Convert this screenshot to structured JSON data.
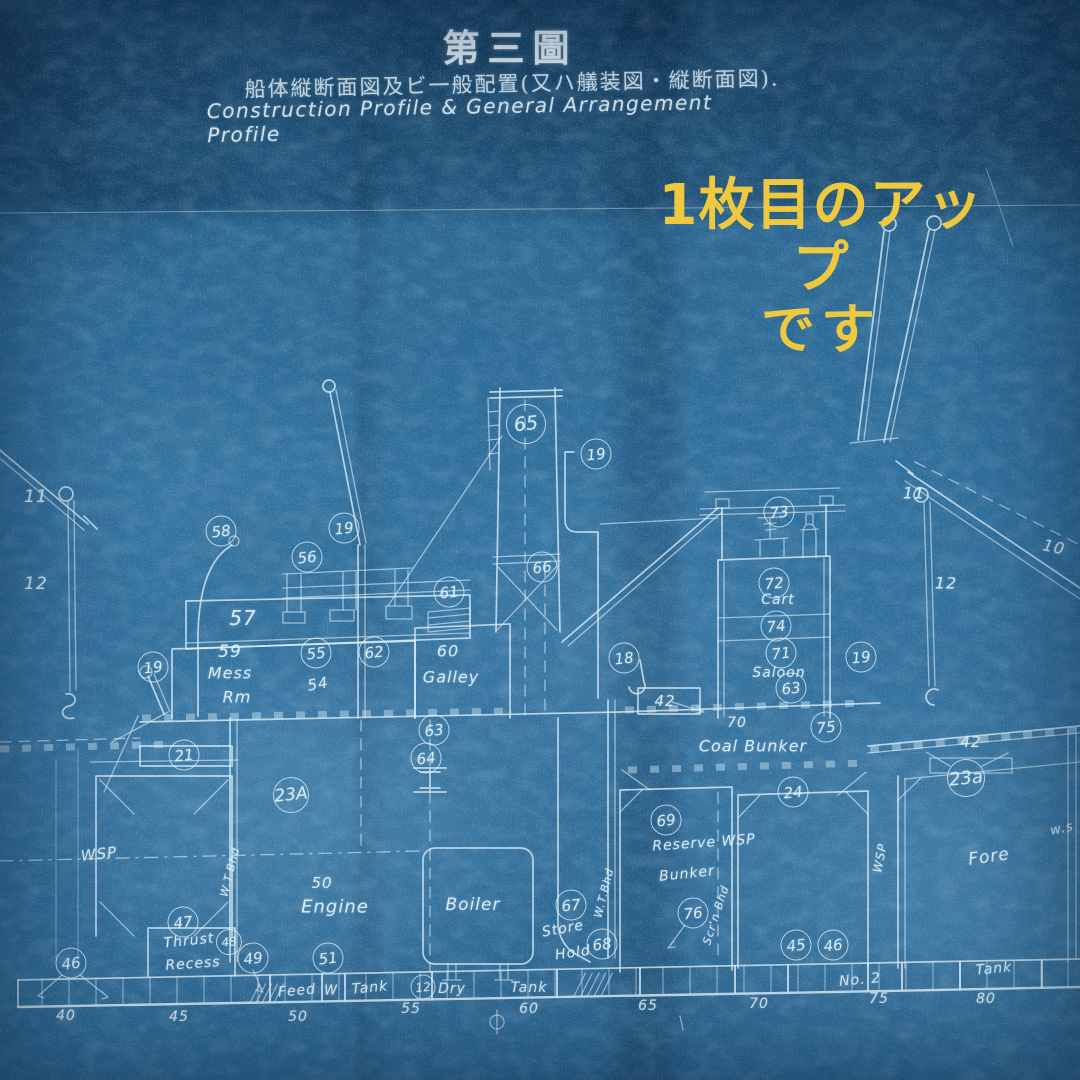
{
  "header": {
    "title_jp": "第三圖",
    "subtitle_jp": "船体縦断面図及ビ一般配置(又ハ艤装図・縦断面図).",
    "subtitle_en": "Construction Profile & General Arrangement Profile"
  },
  "overlay_note": {
    "line1": "1枚目のアップ",
    "line2": "です",
    "color": "#efc93d"
  },
  "colors": {
    "paper": "#2e6f9d",
    "line": "#dceef9",
    "lettering": "#e4f3fc"
  },
  "labels": [
    {
      "t": "11",
      "x": 36,
      "y": 497,
      "s": 17
    },
    {
      "t": "12",
      "x": 36,
      "y": 584,
      "s": 17
    },
    {
      "t": "11",
      "x": 914,
      "y": 493,
      "s": 16
    },
    {
      "t": "12",
      "x": 946,
      "y": 583,
      "s": 16
    },
    {
      "t": "10",
      "x": 1054,
      "y": 547,
      "s": 16,
      "r": 12
    },
    {
      "t": "57",
      "x": 243,
      "y": 618,
      "s": 20
    },
    {
      "t": "59",
      "x": 230,
      "y": 652,
      "s": 17
    },
    {
      "t": "Mess",
      "x": 230,
      "y": 673,
      "s": 16
    },
    {
      "t": "Rm",
      "x": 237,
      "y": 697,
      "s": 16
    },
    {
      "t": "54",
      "x": 318,
      "y": 684,
      "s": 15,
      "r": -10
    },
    {
      "t": "60",
      "x": 448,
      "y": 651,
      "s": 16
    },
    {
      "t": "Galley",
      "x": 451,
      "y": 677,
      "s": 16
    },
    {
      "t": "42",
      "x": 665,
      "y": 701,
      "s": 15
    },
    {
      "t": "Cart",
      "x": 778,
      "y": 600,
      "s": 14
    },
    {
      "t": "Saloon",
      "x": 779,
      "y": 673,
      "s": 14
    },
    {
      "t": "70",
      "x": 737,
      "y": 723,
      "s": 14
    },
    {
      "t": "Coal Bunker",
      "x": 753,
      "y": 746,
      "s": 16
    },
    {
      "t": "42",
      "x": 971,
      "y": 742,
      "s": 15
    },
    {
      "t": "WSP",
      "x": 99,
      "y": 854,
      "s": 15,
      "r": -6
    },
    {
      "t": "WSP",
      "x": 880,
      "y": 858,
      "s": 12,
      "r": -78
    },
    {
      "t": "w.s",
      "x": 1062,
      "y": 829,
      "s": 13,
      "r": -12
    },
    {
      "t": "Fore",
      "x": 989,
      "y": 857,
      "s": 17,
      "r": -8
    },
    {
      "t": "50",
      "x": 322,
      "y": 883,
      "s": 15
    },
    {
      "t": "Engine",
      "x": 335,
      "y": 907,
      "s": 18
    },
    {
      "t": "Boiler",
      "x": 473,
      "y": 905,
      "s": 17
    },
    {
      "t": "Store",
      "x": 563,
      "y": 929,
      "s": 14,
      "r": -10
    },
    {
      "t": "Hold",
      "x": 573,
      "y": 953,
      "s": 14,
      "r": -8
    },
    {
      "t": "Reserve WSP",
      "x": 704,
      "y": 843,
      "s": 14,
      "r": -4
    },
    {
      "t": "Bunker",
      "x": 687,
      "y": 874,
      "s": 14,
      "r": -6
    },
    {
      "t": "Thrust",
      "x": 189,
      "y": 941,
      "s": 14,
      "r": -6
    },
    {
      "t": "Recess",
      "x": 193,
      "y": 964,
      "s": 14,
      "r": -4
    },
    {
      "t": "Feed",
      "x": 297,
      "y": 991,
      "s": 14,
      "r": -5
    },
    {
      "t": "W",
      "x": 331,
      "y": 991,
      "s": 13
    },
    {
      "t": "Tank",
      "x": 370,
      "y": 988,
      "s": 14,
      "r": -5
    },
    {
      "t": "Dry",
      "x": 452,
      "y": 989,
      "s": 14
    },
    {
      "t": "Tank",
      "x": 529,
      "y": 988,
      "s": 14
    },
    {
      "t": "No. 2",
      "x": 860,
      "y": 980,
      "s": 14,
      "r": -5
    },
    {
      "t": "Tank",
      "x": 994,
      "y": 969,
      "s": 14,
      "r": -5
    },
    {
      "t": "W.T.Bhd",
      "x": 230,
      "y": 872,
      "s": 11,
      "r": -76
    },
    {
      "t": "W.T.Bhd",
      "x": 604,
      "y": 893,
      "s": 11,
      "r": -76
    },
    {
      "t": "Scr'n Bhd",
      "x": 716,
      "y": 915,
      "s": 11,
      "r": -72
    },
    {
      "t": "40",
      "x": 66,
      "y": 1016,
      "s": 14
    },
    {
      "t": "45",
      "x": 179,
      "y": 1017,
      "s": 14
    },
    {
      "t": "50",
      "x": 298,
      "y": 1017,
      "s": 14
    },
    {
      "t": "55",
      "x": 411,
      "y": 1009,
      "s": 14
    },
    {
      "t": "60",
      "x": 529,
      "y": 1009,
      "s": 14
    },
    {
      "t": "65",
      "x": 648,
      "y": 1006,
      "s": 14
    },
    {
      "t": "70",
      "x": 759,
      "y": 1004,
      "s": 14
    },
    {
      "t": "75",
      "x": 879,
      "y": 999,
      "s": 14
    },
    {
      "t": "80",
      "x": 986,
      "y": 999,
      "s": 14
    }
  ],
  "circles": [
    {
      "t": "58",
      "x": 221,
      "y": 531
    },
    {
      "t": "19",
      "x": 344,
      "y": 528
    },
    {
      "t": "56",
      "x": 307,
      "y": 557
    },
    {
      "t": "65",
      "x": 526,
      "y": 424,
      "d": 40
    },
    {
      "t": "19",
      "x": 596,
      "y": 454
    },
    {
      "t": "66",
      "x": 542,
      "y": 567
    },
    {
      "t": "61",
      "x": 449,
      "y": 592
    },
    {
      "t": "73",
      "x": 779,
      "y": 512
    },
    {
      "t": "72",
      "x": 774,
      "y": 583
    },
    {
      "t": "74",
      "x": 776,
      "y": 626
    },
    {
      "t": "71",
      "x": 781,
      "y": 653
    },
    {
      "t": "63",
      "x": 791,
      "y": 688
    },
    {
      "t": "19",
      "x": 861,
      "y": 657
    },
    {
      "t": "55",
      "x": 316,
      "y": 653
    },
    {
      "t": "62",
      "x": 374,
      "y": 652
    },
    {
      "t": "19",
      "x": 153,
      "y": 667
    },
    {
      "t": "18",
      "x": 624,
      "y": 658
    },
    {
      "t": "63",
      "x": 434,
      "y": 730
    },
    {
      "t": "64",
      "x": 426,
      "y": 758
    },
    {
      "t": "21",
      "x": 184,
      "y": 755
    },
    {
      "t": "23A",
      "x": 291,
      "y": 795,
      "d": 36
    },
    {
      "t": "23a",
      "x": 966,
      "y": 778,
      "d": 38
    },
    {
      "t": "75",
      "x": 826,
      "y": 727
    },
    {
      "t": "69",
      "x": 666,
      "y": 820
    },
    {
      "t": "76",
      "x": 693,
      "y": 913
    },
    {
      "t": "24",
      "x": 793,
      "y": 792
    },
    {
      "t": "47",
      "x": 183,
      "y": 922
    },
    {
      "t": "48",
      "x": 229,
      "y": 942,
      "d": 26
    },
    {
      "t": "49",
      "x": 253,
      "y": 958
    },
    {
      "t": "51",
      "x": 328,
      "y": 958
    },
    {
      "t": "67",
      "x": 571,
      "y": 905
    },
    {
      "t": "68",
      "x": 602,
      "y": 944
    },
    {
      "t": "12",
      "x": 423,
      "y": 987,
      "d": 25
    },
    {
      "t": "45",
      "x": 796,
      "y": 945
    },
    {
      "t": "46",
      "x": 833,
      "y": 945
    },
    {
      "t": "46",
      "x": 71,
      "y": 963
    }
  ]
}
